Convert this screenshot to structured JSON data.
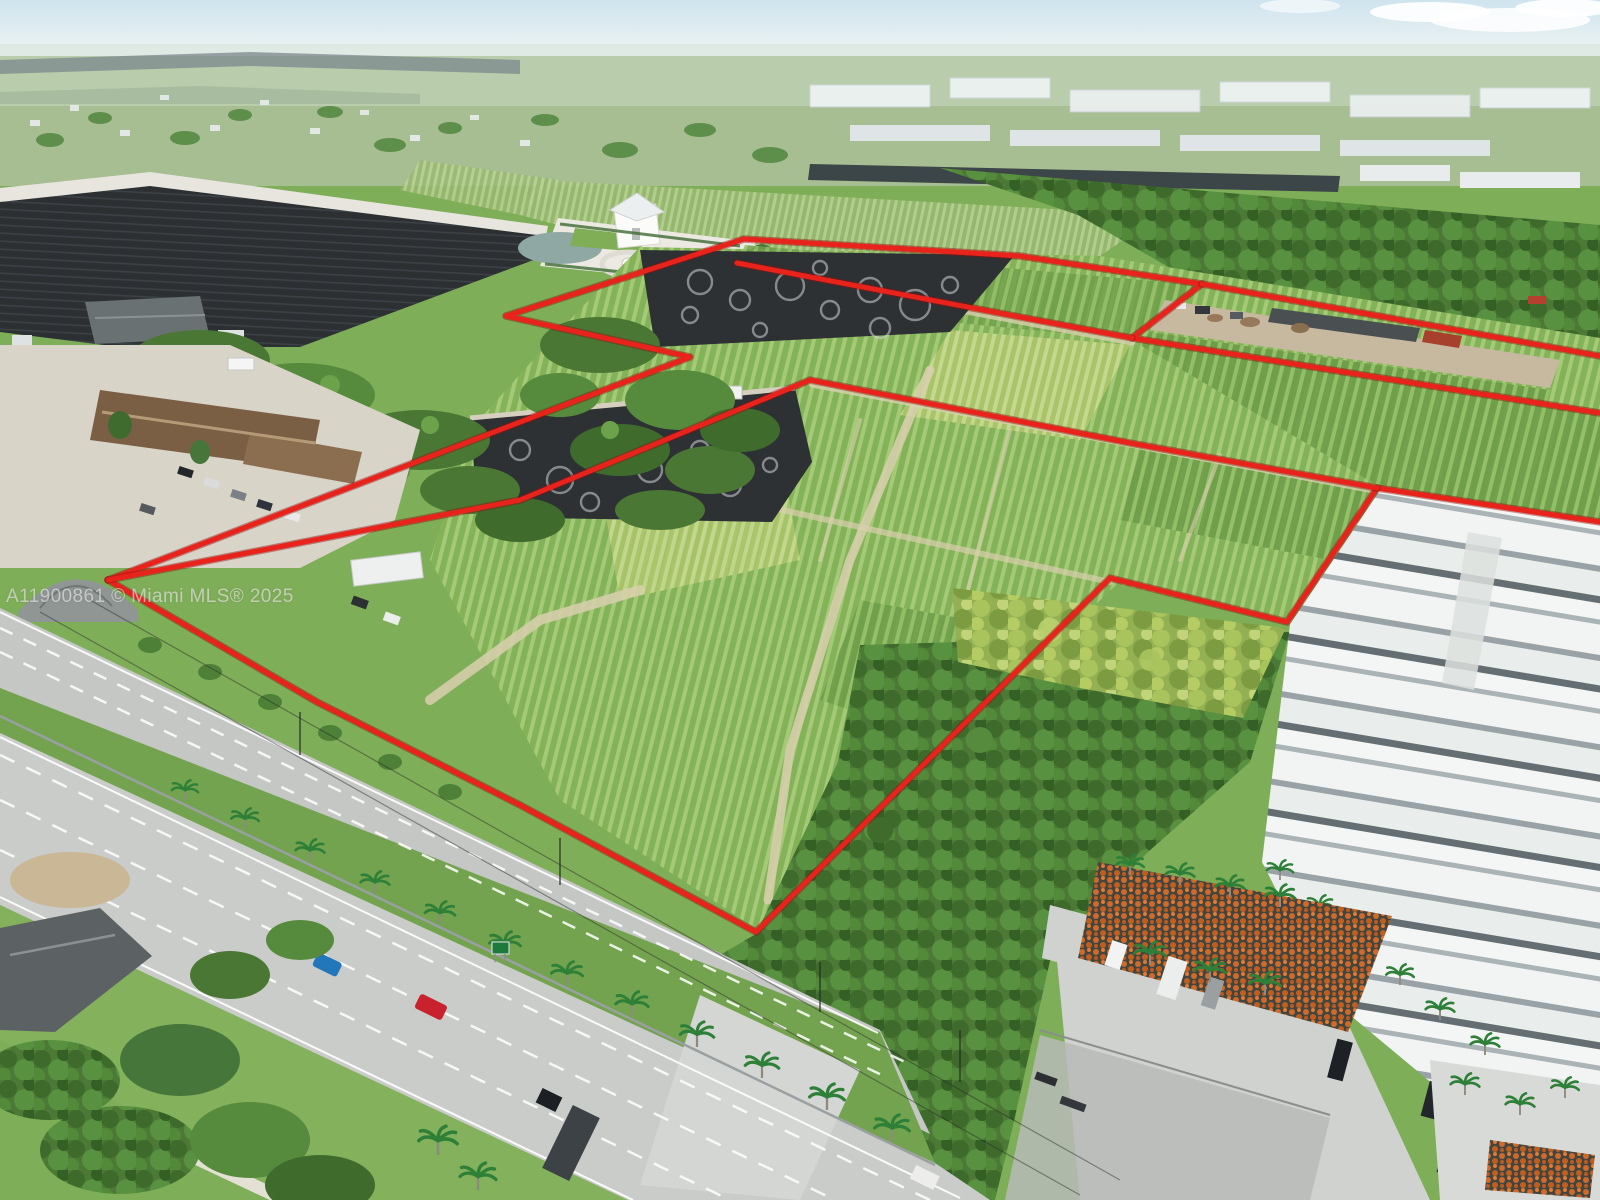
{
  "title": "Aerial nursery land listing photo",
  "watermark": {
    "text": "A11900861 © Miami MLS® 2025"
  },
  "annotation": {
    "boundary_color": "#e8231c",
    "boundary_underlay": "#8f100d",
    "stroke_width": 5,
    "paths": [
      {
        "name": "north-parcel-outline",
        "points": [
          [
            108,
            580
          ],
          [
            690,
            357
          ],
          [
            506,
            316
          ],
          [
            744,
            239
          ],
          [
            1020,
            256
          ],
          [
            1202,
            284
          ],
          [
            1132,
            338
          ],
          [
            1600,
            413
          ]
        ]
      },
      {
        "name": "north-band-top-edge",
        "points": [
          [
            1202,
            284
          ],
          [
            1600,
            356
          ]
        ]
      },
      {
        "name": "mid-divider",
        "points": [
          [
            737,
            263
          ],
          [
            1020,
            317
          ],
          [
            1132,
            338
          ]
        ]
      },
      {
        "name": "south-outline",
        "points": [
          [
            108,
            580
          ],
          [
            317,
            702
          ],
          [
            520,
            805
          ],
          [
            756,
            932
          ],
          [
            1110,
            578
          ],
          [
            1287,
            622
          ],
          [
            1377,
            488
          ],
          [
            1600,
            522
          ]
        ]
      },
      {
        "name": "parcel-two-top-edge",
        "points": [
          [
            108,
            580
          ],
          [
            520,
            500
          ],
          [
            810,
            380
          ],
          [
            1130,
            443
          ],
          [
            1377,
            488
          ]
        ]
      }
    ]
  },
  "scene": {
    "sky": "#d2e5ef",
    "haze": "#c3d5c5",
    "vegetation_base": "#7fae58",
    "road_surface": "#c9ccc9",
    "shade_cloth": "#2d3134",
    "dirt_path": "#d9cfae",
    "greenhouse_roof": "#f1f4f3",
    "pot_orange": "#cf6a2a"
  }
}
